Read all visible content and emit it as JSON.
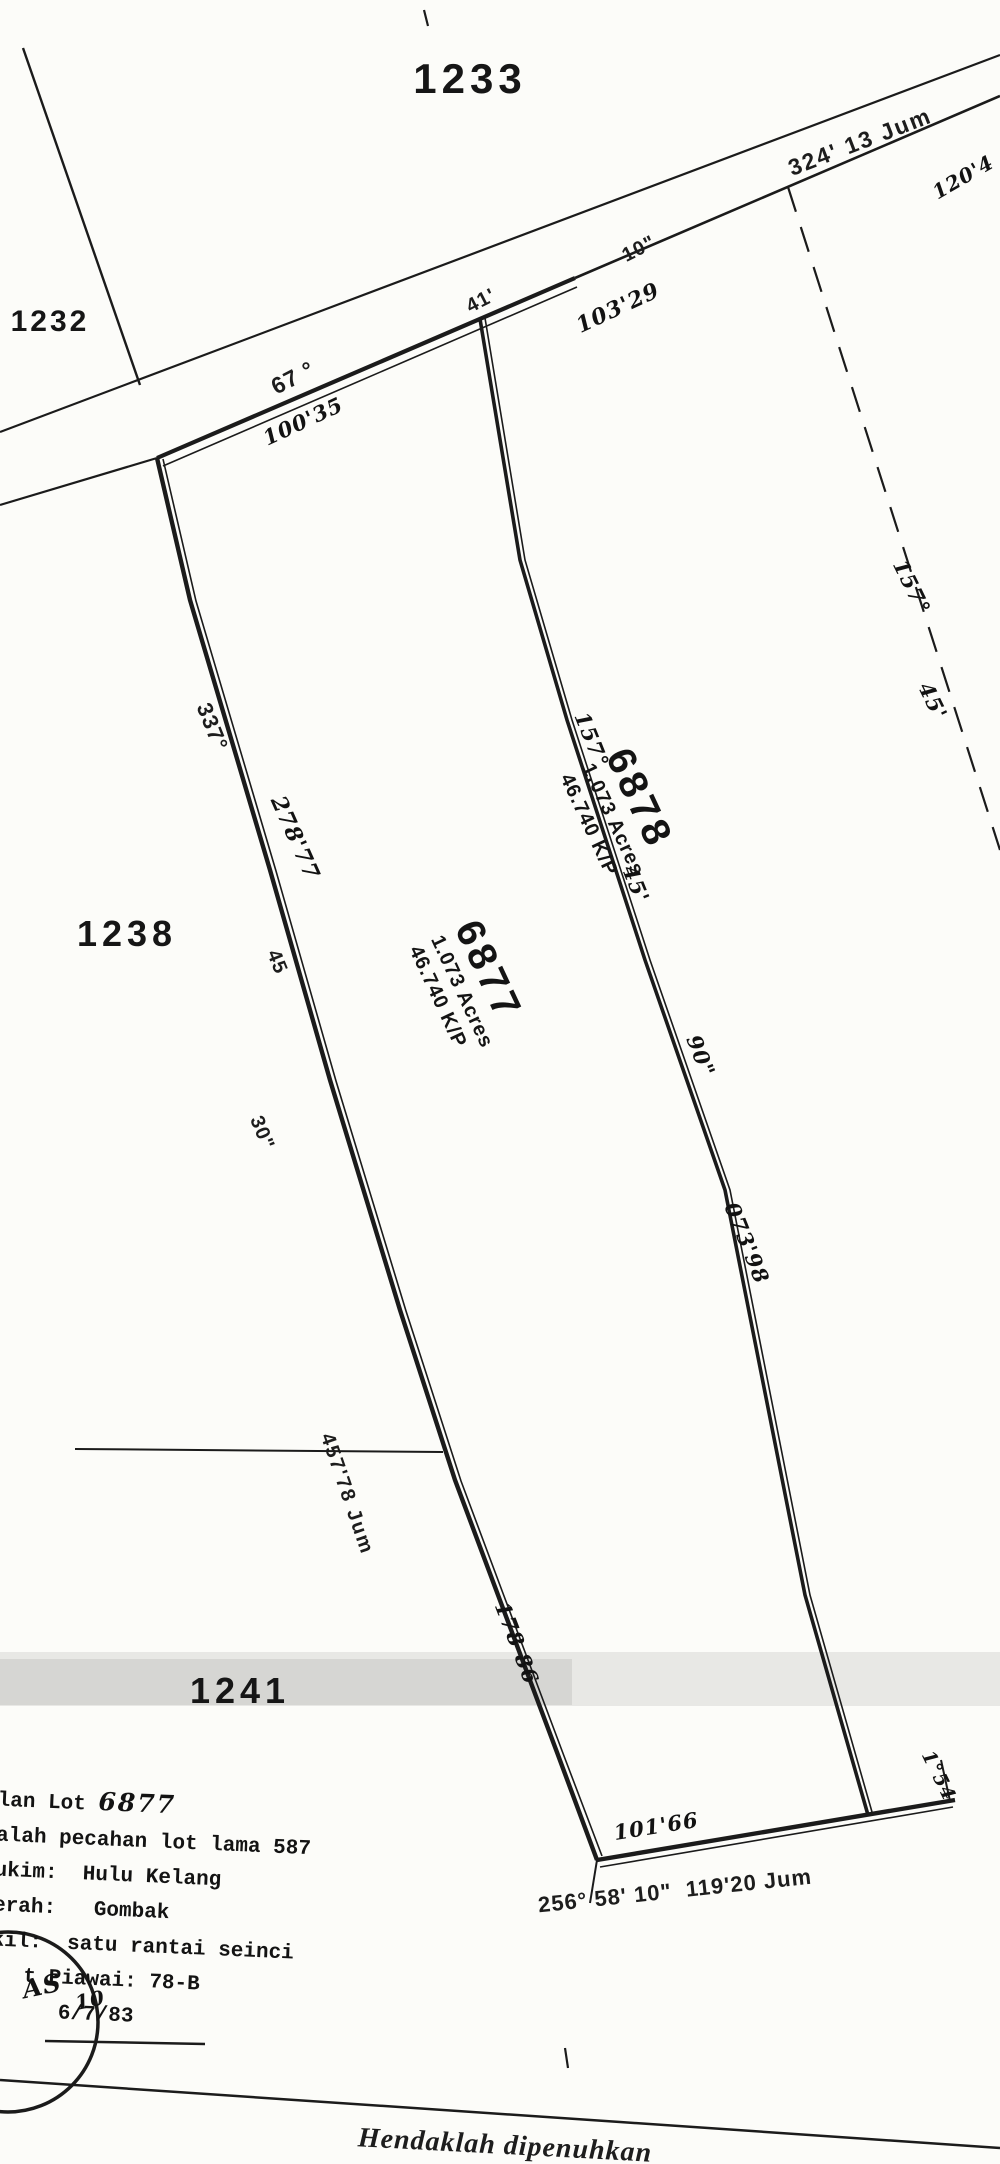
{
  "lots": {
    "l1233": "1233",
    "l1232": "1232",
    "l1238": "1238",
    "l1241": "1241"
  },
  "parcel_6877": {
    "number": "6877",
    "acres": "1.073 Acres",
    "kp": "46.740 K/P"
  },
  "parcel_6878": {
    "number": "6878",
    "acres": "1.073 Acres",
    "kp": "46.740 K/P"
  },
  "north_edge": {
    "deg": "67 °",
    "min": "41'",
    "sec": "10\"",
    "dist_total": "324' 13 Jum",
    "dist_6877": "100'35",
    "dist_6878": "103'29",
    "dist_far": "120'4"
  },
  "west_edge": {
    "deg": "337°",
    "min": "45",
    "sec": "30\"",
    "dist_upper": "278'77",
    "dist_lower": "178 86",
    "dist_total": "457'78 Jum"
  },
  "mid_edge": {
    "deg": "157°",
    "min": "45'",
    "sec": "90\"",
    "dist": "073'98"
  },
  "east_edge": {
    "deg": "157°",
    "min": "45'"
  },
  "south_edge": {
    "bearing_dist": "256° 58' 10\"  119'20 Jum",
    "dist_hw": "101'66",
    "corner_hw": "1°54"
  },
  "notes": {
    "line1_prefix": "elan Lot ",
    "line1_lot": "6877",
    "line2": "dalah pecahan lot lama 587",
    "line3": "lukim:  Hulu Kelang",
    "line4": "aerah:   Gombak",
    "line5": "ekil:  satu rantai seinci",
    "line6": "t Piawai: 78-B",
    "line7": "6/7/83"
  },
  "stamp": {
    "t1": "AS",
    "t2": "10"
  },
  "footer": {
    "note": "Hendaklah dipenuhkan"
  }
}
